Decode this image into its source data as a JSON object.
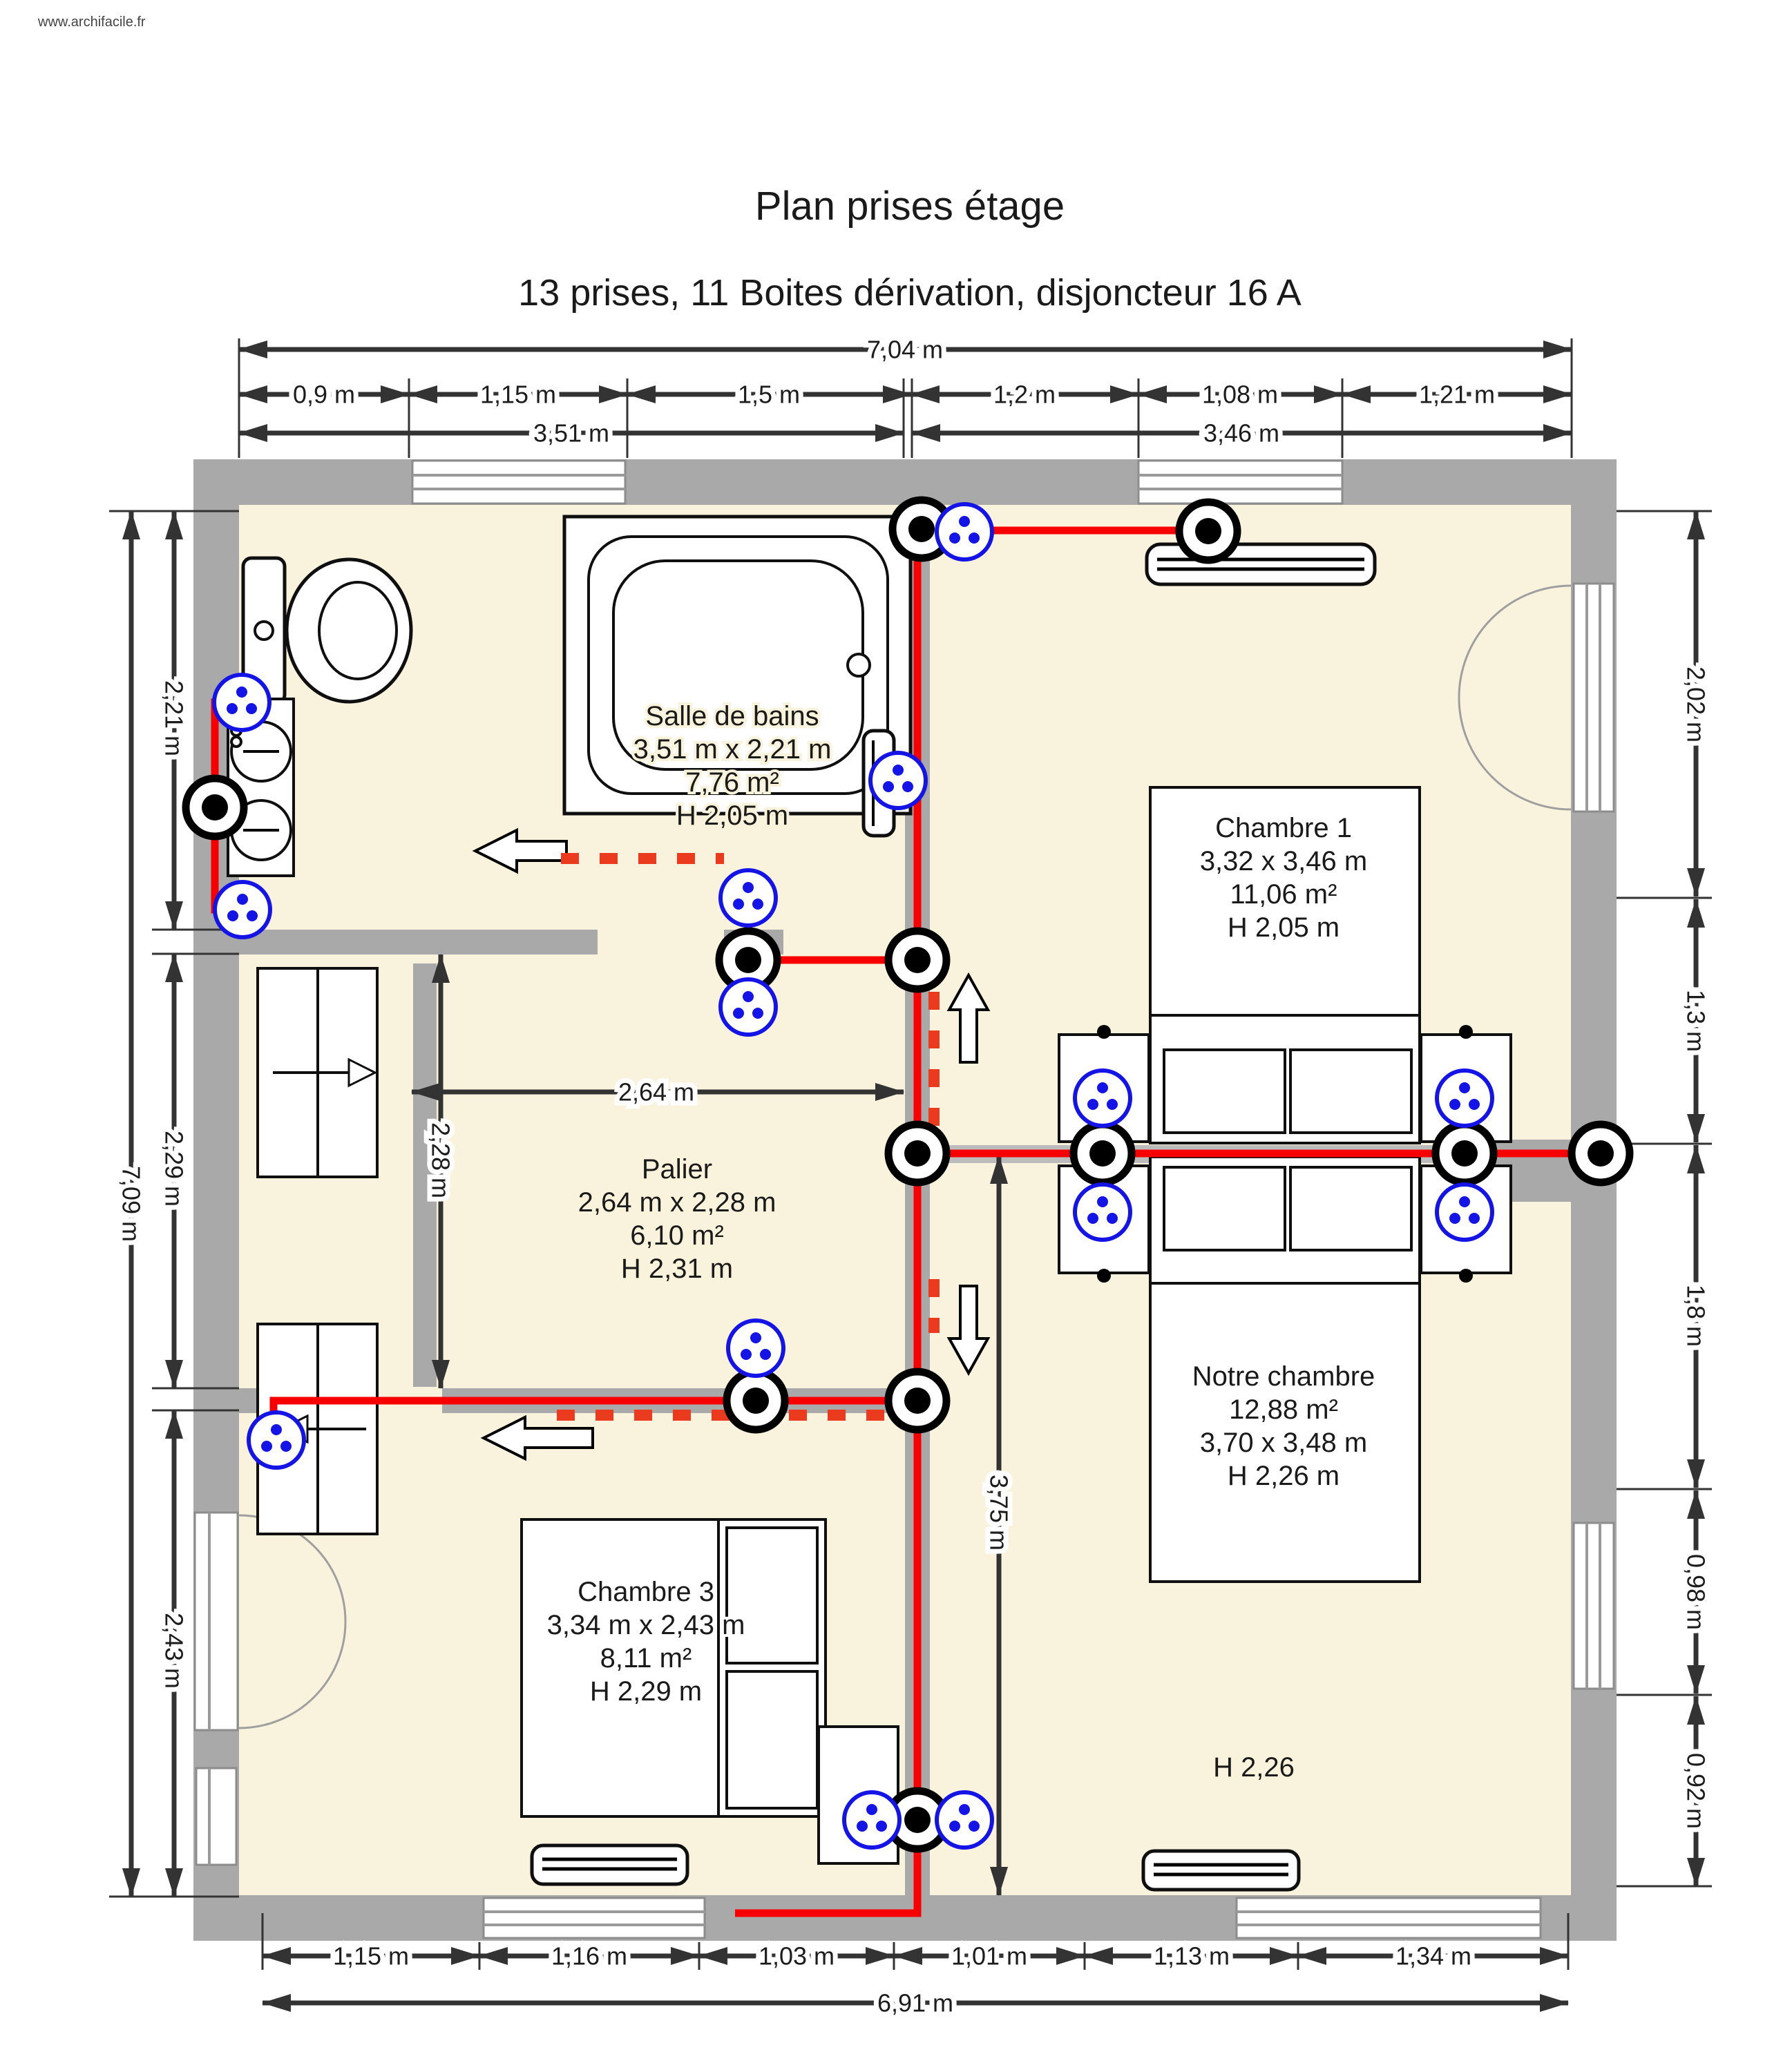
{
  "watermark": "www.archifacile.fr",
  "title": "Plan prises étage",
  "subtitle": "13 prises, 11 Boites dérivation, disjoncteur 16 A",
  "rooms": {
    "salle_de_bains": {
      "lines": [
        "Salle de bains",
        "3,51 m x 2,21 m",
        "7,76 m²",
        "H 2,05 m"
      ]
    },
    "chambre1": {
      "lines": [
        "Chambre 1",
        "3,32 x 3,46 m",
        "11,06 m²",
        "H 2,05 m"
      ]
    },
    "palier": {
      "lines": [
        "Palier",
        "2,64 m x 2,28 m",
        "6,10 m²",
        "H 2,31 m"
      ]
    },
    "notre_chambre": {
      "lines": [
        "Notre chambre",
        "12,88 m²",
        "3,70 x 3,48 m",
        "H 2,26 m"
      ]
    },
    "chambre3": {
      "lines": [
        "Chambre 3",
        "3,34 m x 2,43 m",
        "8,11 m²",
        "H 2,29 m"
      ]
    }
  },
  "annotations": {
    "height_note": "H 2,26"
  },
  "dims": {
    "top_total": "7,04 m",
    "top_segments": [
      "0,9 m",
      "1,15 m",
      "1,5 m",
      "1,2 m",
      "1,08 m",
      "1,21 m"
    ],
    "top_halves": [
      "3,51 m",
      "3,46 m"
    ],
    "bottom_segments": [
      "1,15 m",
      "1,16 m",
      "1,03 m",
      "1,01 m",
      "1,13 m",
      "1,34 m"
    ],
    "bottom_total": "6,91 m",
    "left_segments": [
      "2,21 m",
      "2,29 m",
      "2,43 m"
    ],
    "left_total": "7,09 m",
    "right_segments": [
      "2,02 m",
      "1,3 m",
      "1,8 m",
      "0,98 m",
      "0,92 m"
    ],
    "palier_width": "2,64 m",
    "palier_height": "2,28 m",
    "notre_chambre_height": "3,75 m"
  },
  "symbols": {
    "outlet_count": 14,
    "junction_count": 12,
    "outlet_name": "prise",
    "junction_name": "boite de dérivation"
  },
  "colors": {
    "wall": "#a9a9a9",
    "floor": "#f9f2dc",
    "wire": "#f60000",
    "dashed_run": "#ea3b1f",
    "outlet": "#1414e6",
    "dimension": "#333333"
  }
}
